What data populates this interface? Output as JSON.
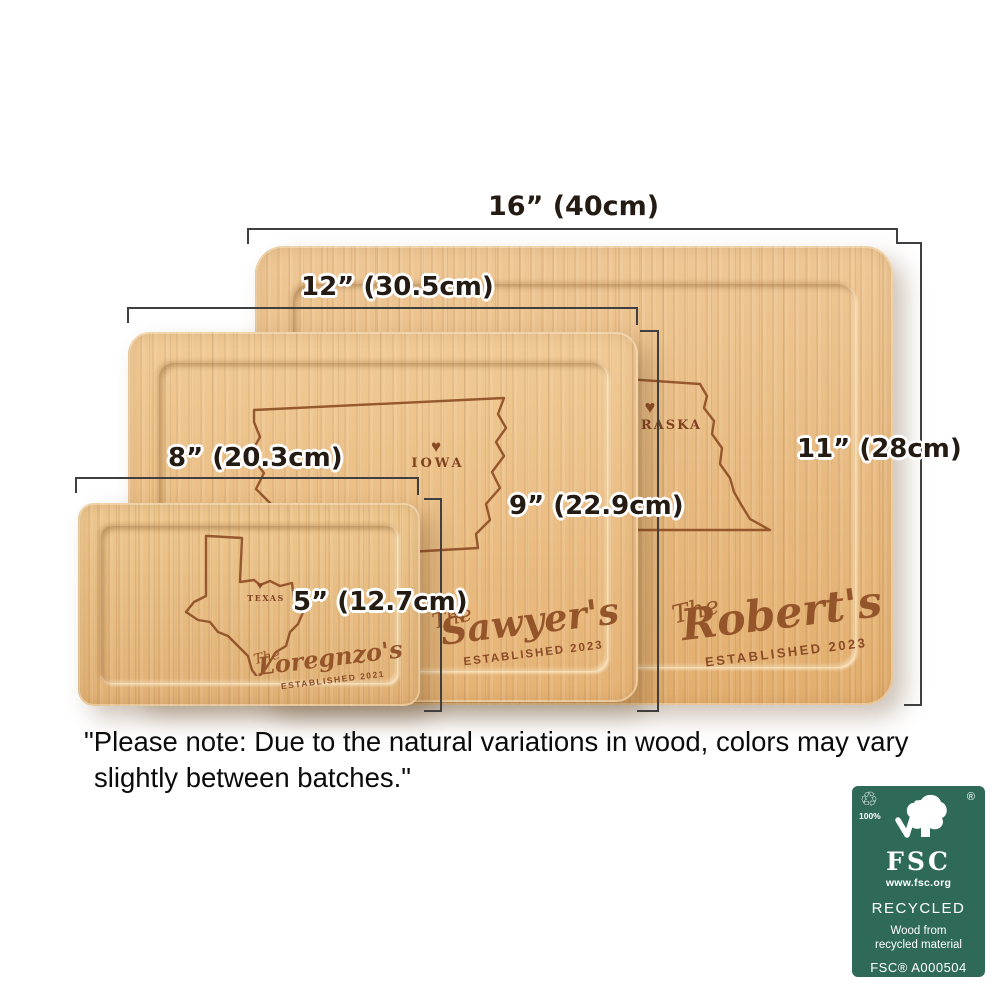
{
  "dimension_labels": {
    "board_large_width": "16” (40cm)",
    "board_medium_width": "12” (30.5cm)",
    "board_small_width": "8” (20.3cm)",
    "board_medium_height": "9” (22.9cm)",
    "board_small_height": "5” (12.7cm)",
    "board_large_height": "11” (28cm)"
  },
  "boards": {
    "large": {
      "state_label": "NEBRASKA",
      "name_prefix": "The",
      "family_name": "Robert's",
      "established_line": "ESTABLISHED 2023"
    },
    "medium": {
      "state_label": "IOWA",
      "name_prefix": "The",
      "family_name": "Sawyer's",
      "established_line": "ESTABLISHED 2023"
    },
    "small": {
      "state_label": "TEXAS",
      "name_prefix": "The",
      "family_name": "Loregnzo's",
      "established_line": "ESTABLISHED 2021"
    }
  },
  "icons": {
    "heart": "♥",
    "recycle": "♲"
  },
  "note": {
    "line1": "\"Please note: Due to the natural variations in wood, colors may vary",
    "line2": "slightly between batches.\""
  },
  "fsc": {
    "percent": "100%",
    "registered_mark": "®",
    "brand": "FSC",
    "website": "www.fsc.org",
    "category": "RECYCLED",
    "description_line1": "Wood from",
    "description_line2": "recycled material",
    "license_code": "FSC® A000504",
    "background_color": "#2f6a58"
  },
  "colors": {
    "engraving": "#8e4e25",
    "dimension_line": "#3f3f3f",
    "dimension_text": "#241b13",
    "wood_light": "#eec795",
    "wood_dark": "#e2ae6e"
  }
}
